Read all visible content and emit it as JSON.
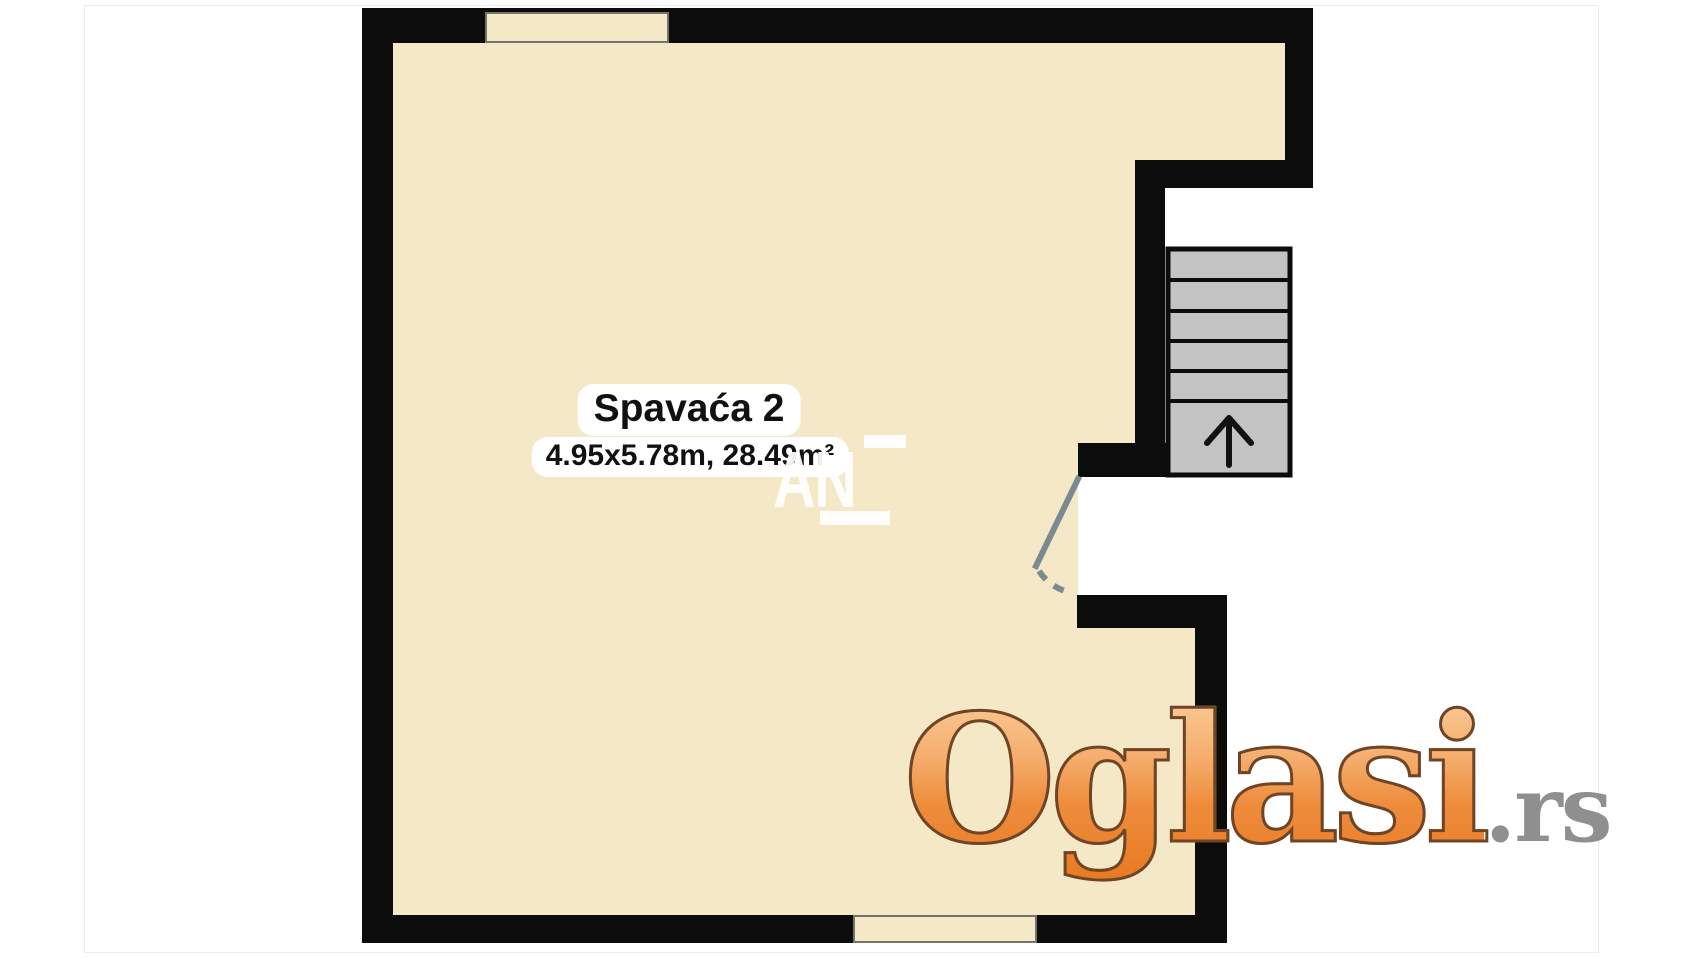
{
  "floor_plan": {
    "room": {
      "name": "Spavaća 2",
      "dimensions_label": "4.95x5.78m, 28.49m²",
      "width_m": "4.95",
      "length_m": "5.78",
      "area_m2": "28.49"
    },
    "stairs": {
      "steps_visible": 5,
      "direction_icon": "arrow-up-icon"
    },
    "features": [
      "top-window",
      "bottom-window",
      "staircase",
      "door-with-swing-arc"
    ],
    "colors": {
      "room_fill": "#f4e8c7",
      "wall": "#0c0c0c",
      "stairs_fill": "#c3c3c3",
      "stairs_border": "#111111",
      "door_leaf": "#7b8a90",
      "window_border": "#75746a",
      "logo_orange": "#ee8330",
      "logo_outline": "#6e4526",
      "logo_tld_gray": "#8f8f8f"
    }
  },
  "watermarks": {
    "agency_text": "AN",
    "site_logo_text": "Oglasi",
    "site_logo_tld": ".rs"
  }
}
